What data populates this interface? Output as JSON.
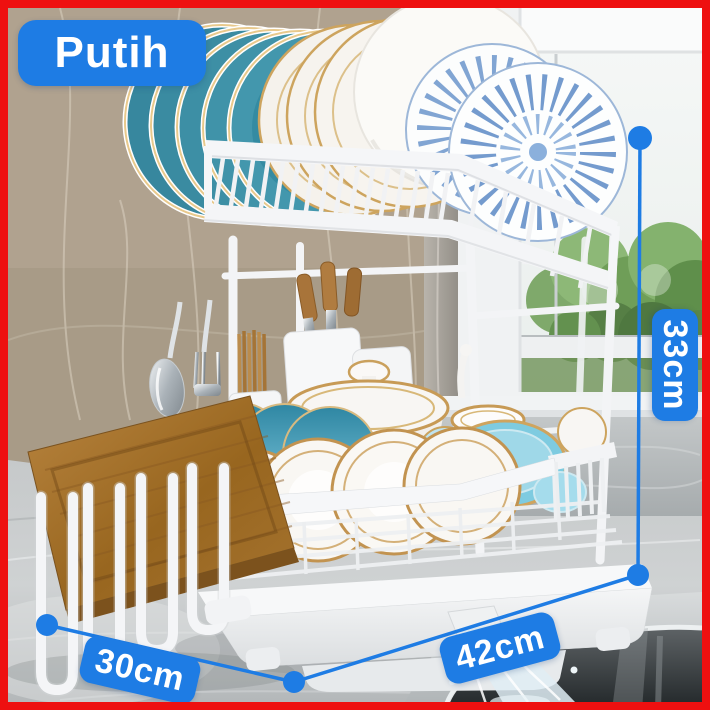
{
  "colors": {
    "accent": "#1e7ce4",
    "border": "#ee1010"
  },
  "badge": {
    "label": "Putih"
  },
  "dimensions": {
    "height": "33cm",
    "width": "42cm",
    "depth": "30cm"
  }
}
